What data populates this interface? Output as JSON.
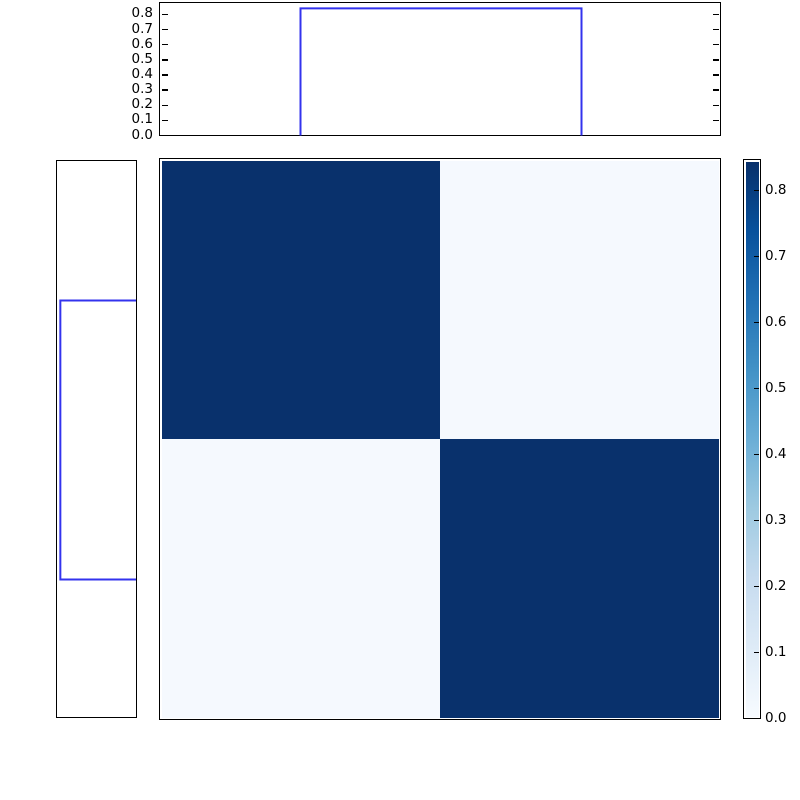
{
  "figure": {
    "width_px": 800,
    "height_px": 800,
    "background_color": "#ffffff",
    "frame_color": "#000000",
    "step_line_color": "#3333ee",
    "text_color": "#000000"
  },
  "chart_data": {
    "type": "heatmap",
    "title": "",
    "description": "2x2 block-diagonal matrix heatmap (Blues colormap) with step-histogram marginals on top and left, and a vertical colorbar on the right",
    "grid": false,
    "tick_direction": "in",
    "matrix": {
      "n_rows": 2,
      "n_cols": 2,
      "values": [
        [
          0.84,
          0.02
        ],
        [
          0.02,
          0.84
        ]
      ],
      "cell_colors": [
        [
          "#09316c",
          "#f5f9fe"
        ],
        [
          "#f5f9fe",
          "#09316c"
        ]
      ]
    },
    "colormap": {
      "name": "Blues",
      "stops": [
        "#f7fbff",
        "#deebf7",
        "#c6dbef",
        "#9ecae1",
        "#6baed6",
        "#4292c6",
        "#2171b5",
        "#08519c",
        "#08306b"
      ]
    },
    "colorbar": {
      "position": "right",
      "vmin": 0.0,
      "vmax": 0.844,
      "ticks": [
        0.0,
        0.1,
        0.2,
        0.3,
        0.4,
        0.5,
        0.6,
        0.7,
        0.8
      ],
      "tick_labels": [
        "0.0",
        "0.1",
        "0.2",
        "0.3",
        "0.4",
        "0.5",
        "0.6",
        "0.7",
        "0.8"
      ]
    },
    "top_marginal": {
      "plot_type": "step",
      "ylim": [
        0.0,
        0.866
      ],
      "yticks": [
        0.0,
        0.1,
        0.2,
        0.3,
        0.4,
        0.5,
        0.6,
        0.7,
        0.8
      ],
      "ytick_labels": [
        "0.0",
        "0.1",
        "0.2",
        "0.3",
        "0.4",
        "0.5",
        "0.6",
        "0.7",
        "0.8"
      ],
      "step_height": 0.84,
      "step_start_frac": 0.25,
      "step_end_frac": 0.75,
      "ticks_on_left_and_right": true
    },
    "left_marginal": {
      "plot_type": "step",
      "value_axis_max": 0.866,
      "value_axis_inverted": true,
      "step_height": 0.84,
      "step_start_frac": 0.25,
      "step_end_frac": 0.75,
      "ticks_visible": false
    }
  }
}
